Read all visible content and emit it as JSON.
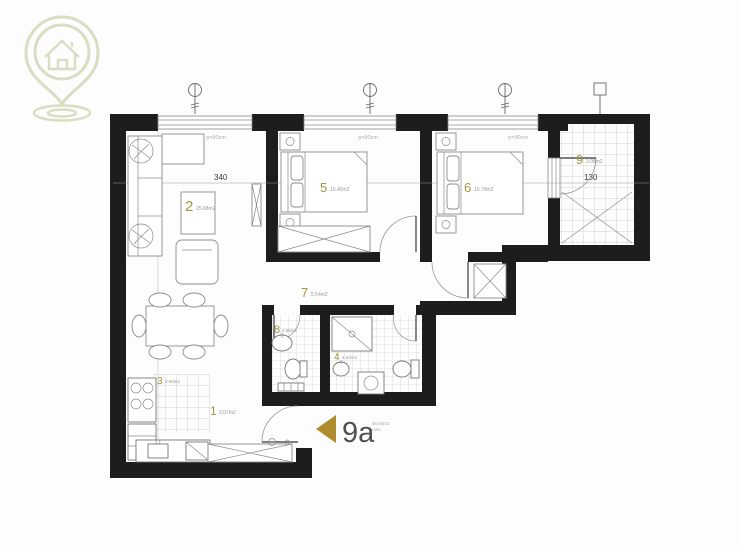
{
  "logo": {
    "name": "house-location-pin-logo",
    "color": "#dcdcc2"
  },
  "plan": {
    "unit": {
      "label": "9a",
      "area_line1": "55.90m2",
      "area_line2": "neto"
    },
    "rooms": [
      {
        "number": "1",
        "area": "3.07m2"
      },
      {
        "number": "2",
        "area": "25.68m2"
      },
      {
        "number": "3",
        "area": "3.98m2"
      },
      {
        "number": "4",
        "area": "4.63m2"
      },
      {
        "number": "5",
        "area": "10.45m2"
      },
      {
        "number": "6",
        "area": "10.79m2"
      },
      {
        "number": "7",
        "area": "5.54m2"
      },
      {
        "number": "8",
        "area": "2.95m2"
      },
      {
        "number": "9",
        "area": "3.08m2"
      }
    ],
    "dimensions": {
      "living_width": "340",
      "bedroom5_width": "343",
      "bedroom6_width": "303",
      "terrace_width": "130"
    },
    "window_parapet_label": "p=90cm",
    "colors": {
      "accent": "#ad8c2e",
      "room_number": "#a3953f",
      "wall": "#1d1d1d",
      "logo": "#dcdcc2"
    }
  }
}
